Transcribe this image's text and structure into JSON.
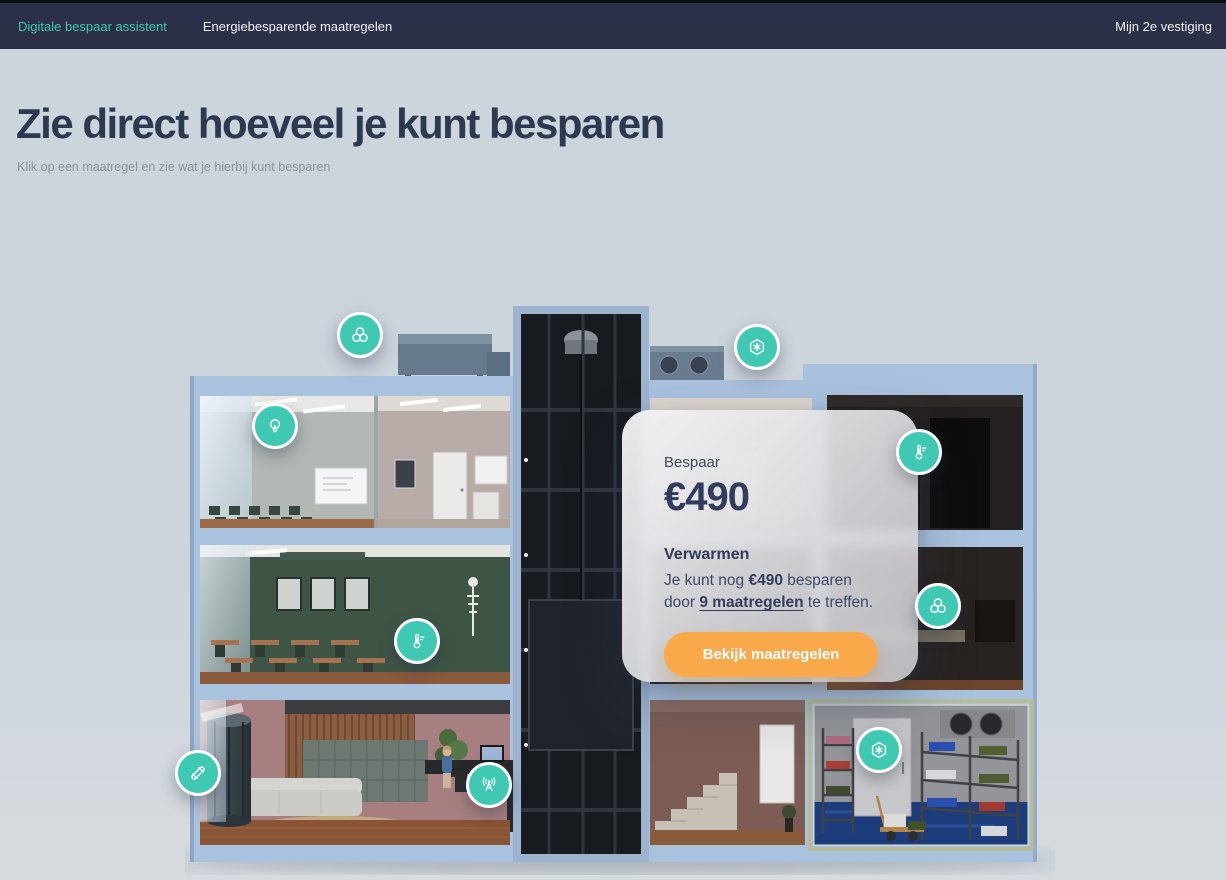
{
  "nav": {
    "items": [
      {
        "label": "Digitale bespaar assistent",
        "active": true
      },
      {
        "label": "Energiebesparende maatregelen",
        "active": false
      }
    ],
    "right_label": "Mijn 2e vestiging"
  },
  "hero": {
    "title": "Zie direct hoeveel je kunt besparen",
    "subtitle": "Klik op een maatregel en zie wat je hierbij kunt besparen"
  },
  "savings_card": {
    "intro_label": "Bespaar",
    "amount": "€490",
    "measure_title": "Verwarmen",
    "sentence_prefix": "Je kunt nog ",
    "sentence_amount": "€490",
    "sentence_mid": " besparen door ",
    "sentence_link": "9 maatregelen",
    "sentence_suffix": " te treffen.",
    "cta_label": "Bekijk maatregelen"
  },
  "markers": [
    {
      "id": "ventilation-roof",
      "icon": "fan",
      "x": 360,
      "y": 335
    },
    {
      "id": "cooling-roof",
      "icon": "hex-snowflake",
      "x": 757,
      "y": 347
    },
    {
      "id": "lighting-classroom",
      "icon": "bulb",
      "x": 275,
      "y": 426
    },
    {
      "id": "heating-storage-room",
      "icon": "thermometer",
      "x": 919,
      "y": 452
    },
    {
      "id": "ventilation-kitchen",
      "icon": "fan",
      "x": 938,
      "y": 606
    },
    {
      "id": "heating-classroom",
      "icon": "thermometer",
      "x": 417,
      "y": 641
    },
    {
      "id": "piping-lobby",
      "icon": "pipe",
      "x": 198,
      "y": 773
    },
    {
      "id": "smart-meter-reception",
      "icon": "antenna",
      "x": 489,
      "y": 785
    },
    {
      "id": "cooling-storage",
      "icon": "hex-snowflake",
      "x": 879,
      "y": 750
    }
  ],
  "colors": {
    "accent_teal": "#3fc8b2",
    "nav_bg": "#2b3048",
    "cta_orange": "#f9a84a",
    "heading_text": "#2c3950",
    "page_bg": "#ccd4dc",
    "building_frame": "#a9c2de",
    "highlight_border": "#b9bd8e"
  }
}
